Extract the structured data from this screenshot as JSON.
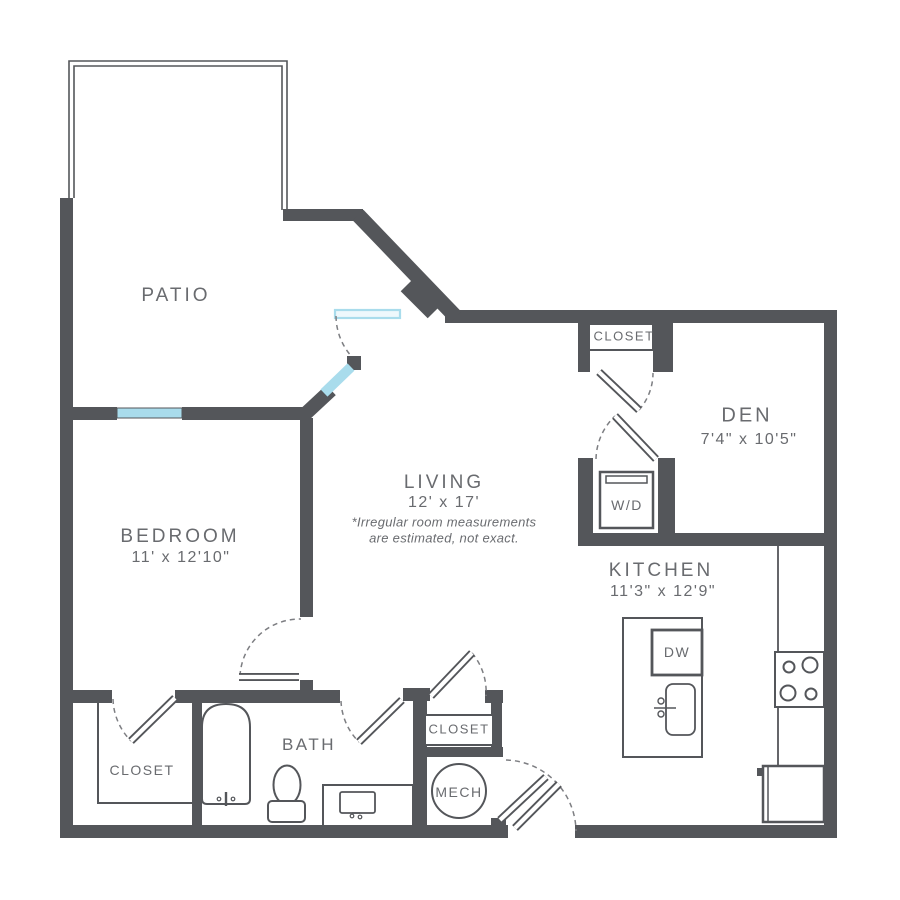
{
  "plan": {
    "type": "apartment-floor-plan",
    "colors": {
      "wall": "#54565a",
      "door_accent": "#a9dcec",
      "label_text": "#696b6f"
    },
    "rooms": {
      "patio": {
        "label": "PATIO"
      },
      "bedroom": {
        "label": "BEDROOM",
        "dims": "11' x 12'10\""
      },
      "living": {
        "label": "LIVING",
        "dims": "12' x 17'",
        "note1": "*Irregular room measurements",
        "note2": "are estimated, not exact."
      },
      "den": {
        "label": "DEN",
        "dims": "7'4\" x 10'5\""
      },
      "kitchen": {
        "label": "KITCHEN",
        "dims": "11'3\" x 12'9\""
      },
      "bath": {
        "label": "BATH"
      },
      "den_closet": {
        "label": "CLOSET"
      },
      "bedroom_closet": {
        "label": "CLOSET"
      },
      "hall_closet": {
        "label": "CLOSET"
      },
      "mech": {
        "label": "MECH"
      },
      "washer_dryer": {
        "label": "W/D"
      },
      "dishwasher": {
        "label": "DW"
      }
    }
  }
}
